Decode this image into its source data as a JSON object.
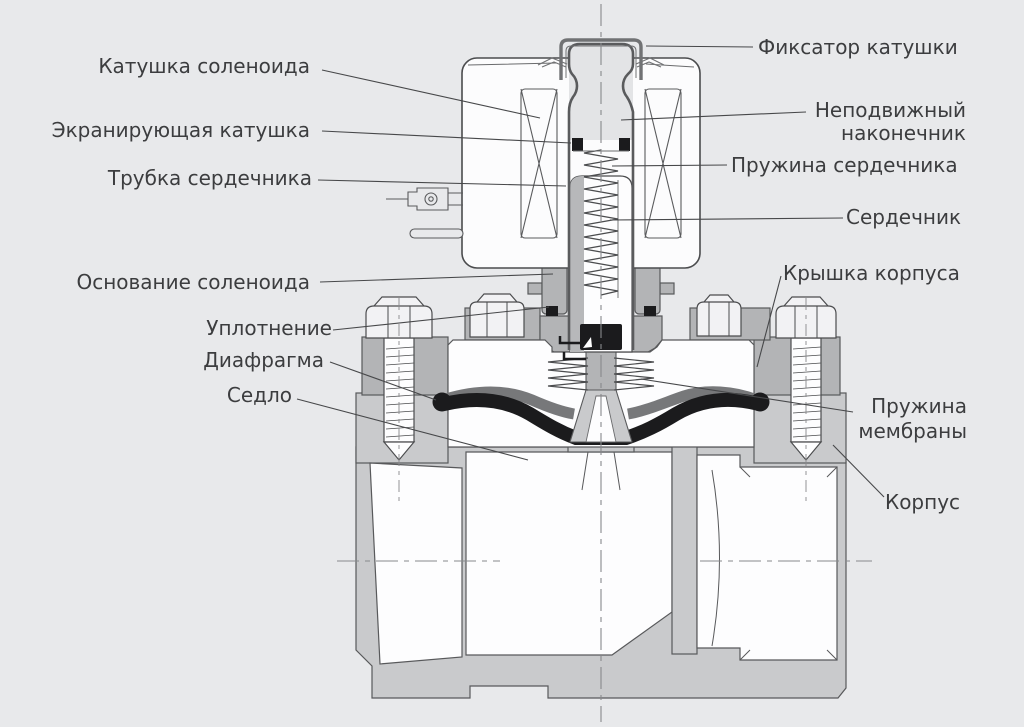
{
  "diagram": {
    "labels": {
      "coil": "Катушка соленоида",
      "shading_coil": "Экранирующая катушка",
      "core_tube": "Трубка сердечника",
      "solenoid_base": "Основание соленоида",
      "seal": "Уплотнение",
      "diaphragm": "Диафрагма",
      "seat": "Седло",
      "coil_retainer": "Фиксатор катушки",
      "fixed_plug": "Неподвижный наконечник",
      "core_spring": "Пружина сердечника",
      "core": "Сердечник",
      "body_cover": "Крышка корпуса",
      "membrane_spring": "Пружина мембраны",
      "body": "Корпус"
    },
    "colors": {
      "background": "#e8e9eb",
      "outline": "#4b4c4e",
      "metal_light": "#c9cacc",
      "metal_mid": "#b3b4b6",
      "diaphragm_gray": "#77787a",
      "seal_black": "#1b1b1d",
      "text": "#3c3d3f"
    }
  }
}
